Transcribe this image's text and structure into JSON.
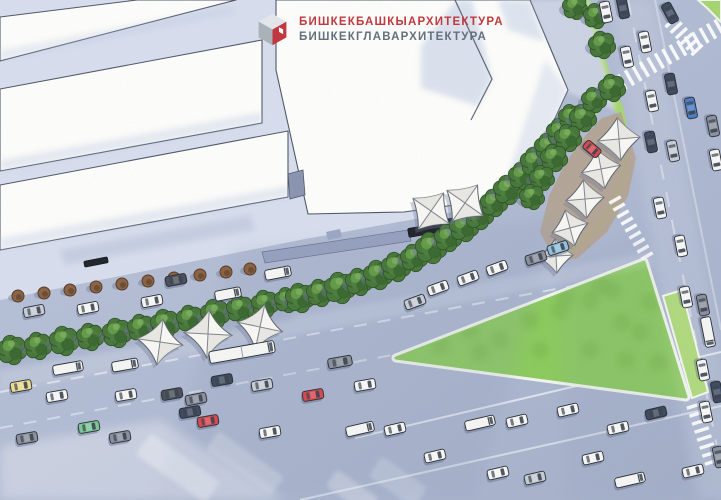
{
  "logo": {
    "line1": "БИШКЕКБАШКЫАРХИТЕКТУРА",
    "line2": "БИШКЕКГЛАВАРХИТЕКТУРА",
    "line1_color": "#c0393f",
    "line2_color": "#64707d",
    "cube_top": "#e3e6e9",
    "cube_left": "#a9b1b9",
    "cube_right": "#c0393f"
  },
  "palette": {
    "road_light": "#bcc5da",
    "road_dark": "#a4afc9",
    "building_area": "#d6ddec",
    "building_fill": "#fcfcfa",
    "building_stroke": "#4f5868",
    "roof_wash": "#b9c6e0",
    "grass": "#a6d471",
    "triangle_fill": "#8bc95e",
    "triangle_spot": "#78b54c",
    "triangle_border": "#f0f4ec",
    "plaza_fill": "#b2a391",
    "tree_dark": "#2d5226",
    "tree_mid": "#47763a",
    "tree_light": "#639a49",
    "tree_hi": "#79ad5c",
    "shrub_fill": "#8a6345",
    "shrub_core": "#6d4c33",
    "shrub_stroke": "#573a26",
    "shadow_blue": "#6d7894",
    "canopy_fill": "#f7f6f2",
    "canopy_shade": "#e4e3dd",
    "canopy_seam": "#80868f",
    "canopy_stroke": "#5d636e",
    "stripe_white": "#ffffff",
    "kiosk_fill": "#22262c",
    "car_outline": "#262b33",
    "car_colors": {
      "white": "#f4f5f3",
      "silver": "#c6cbd3",
      "gray": "#8a909c",
      "dark": "#4b505a",
      "navy": "#3e4a5e",
      "blue": "#4b7cc0",
      "lightblue": "#8fc0dc",
      "red": "#d4494f",
      "yellow": "#e9da8e",
      "green": "#7bc795"
    }
  },
  "scene": {
    "building_area": "0,0 530,0 568,90 519,200 300,240 0,300",
    "buildings": [
      {
        "name": "building-strip-a",
        "points": "0,17 137,0 236,0 0,61"
      },
      {
        "name": "building-strip-b",
        "points": "0,89 262,40 262,123 0,171"
      },
      {
        "name": "building-strip-c",
        "points": "0,185 288,131 288,197 0,250"
      },
      {
        "name": "building-central",
        "points": "276,0 530,0 568,90 519,196 404,212 308,214 276,70"
      }
    ],
    "connector": "288,174 303,170 305,195 290,199",
    "ramp": "262,252 408,230 411,241 265,263",
    "entrance": "326,232 340,229 342,237 328,240",
    "chevron_line": "455,0 492,79 471,120",
    "roof_washes": [
      {
        "points": "421,46 456,0 472,0 492,79 478,106 421,88",
        "o": 0.5
      },
      {
        "points": "498,0 530,0 545,42 508,30",
        "o": 0.45
      },
      {
        "points": "0,160 262,112 262,123 0,171",
        "o": 0.35
      },
      {
        "points": "0,238 288,186 288,197 0,250",
        "o": 0.35
      },
      {
        "points": "545,60 568,90 522,192 505,185",
        "o": 0.35
      },
      {
        "points": "0,50 230,6 236,13 0,61",
        "o": 0.3
      }
    ],
    "washes": [
      {
        "points": "60,250 250,215 255,230 65,265",
        "c": "#93a0bd",
        "o": 0.25,
        "b": 3
      },
      {
        "points": "0,350 290,305 292,322 0,368",
        "c": "#8a96b4",
        "o": 0.2,
        "b": 3
      },
      {
        "points": "235,248 560,218 475,500 155,500",
        "c": "#8795b5",
        "o": 0.13,
        "b": 6
      },
      {
        "points": "560,262 648,228 705,500 566,500",
        "c": "#8a96b4",
        "o": 0.1,
        "b": 6
      },
      {
        "points": "0,372 648,252 654,266 0,392",
        "c": "#ffffff",
        "o": 0.13,
        "b": 3
      },
      {
        "points": "0,446 160,420 285,500 0,500",
        "c": "#ffffff",
        "o": 0.3,
        "b": 5
      },
      {
        "points": "610,0 652,0 748,500 696,500",
        "c": "#ffffff",
        "o": 0.1,
        "b": 5
      },
      {
        "points": "528,0 588,0 616,110 566,92",
        "c": "#d9dfec",
        "o": 0.65,
        "b": 2
      }
    ],
    "lane_lines": [
      {
        "x1": 0,
        "y1": 392,
        "x2": 648,
        "y2": 272,
        "dash": "13 11",
        "o": 0.5
      },
      {
        "x1": 0,
        "y1": 428,
        "x2": 430,
        "y2": 348,
        "dash": "13 11",
        "o": 0.42
      },
      {
        "x1": 355,
        "y1": 438,
        "x2": 721,
        "y2": 352,
        "dash": "",
        "o": 0.6
      },
      {
        "x1": 300,
        "y1": 500,
        "x2": 721,
        "y2": 406,
        "dash": "",
        "o": 0.5
      },
      {
        "x1": 628,
        "y1": 0,
        "x2": 720,
        "y2": 462,
        "dash": "15 13",
        "o": 0.4
      },
      {
        "x1": 655,
        "y1": 0,
        "x2": 721,
        "y2": 330,
        "dash": "",
        "o": 0.32
      }
    ],
    "bands": [
      {
        "x": 178,
        "y": 468,
        "w": 26,
        "l": 85,
        "a": -55,
        "o": 0.32
      },
      {
        "x": 245,
        "y": 463,
        "w": 22,
        "l": 80,
        "a": -55,
        "o": 0.26
      },
      {
        "x": 352,
        "y": 492,
        "w": 20,
        "l": 50,
        "a": -55,
        "o": 0.3
      },
      {
        "x": 398,
        "y": 482,
        "w": 24,
        "l": 55,
        "a": -55,
        "o": 0.22
      }
    ],
    "green": {
      "triangle": "396,358 644,262 686,397",
      "triangle_spots": [
        [
          440,
          345
        ],
        [
          470,
          330
        ],
        [
          500,
          340
        ],
        [
          530,
          320
        ],
        [
          560,
          310
        ],
        [
          590,
          300
        ],
        [
          612,
          290
        ],
        [
          622,
          322
        ],
        [
          640,
          332
        ],
        [
          590,
          350
        ],
        [
          540,
          350
        ],
        [
          480,
          352
        ],
        [
          650,
          302
        ],
        [
          626,
          360
        ],
        [
          658,
          362
        ],
        [
          600,
          285
        ],
        [
          566,
          296
        ]
      ],
      "corner_ne": "698,0 721,0 721,22 707,8",
      "strip_se": "663,296 682,290 708,392 692,398",
      "paths": [
        {
          "d": "M 294,306 Q 470,250 600,104",
          "w": 9
        },
        {
          "d": "M 552,262 Q 648,210 618,104",
          "w": 8
        },
        {
          "d": "M 586,0 L 616,108",
          "w": 7
        }
      ]
    },
    "plaza": "540,232 549,196 566,162 585,136 602,118 621,112 636,158 628,196 607,232 578,258 556,262",
    "crosswalks": [
      {
        "x1": 622,
        "y1": 82,
        "x2": 719,
        "y2": 27,
        "len": 17,
        "n": 14
      },
      {
        "x1": 671,
        "y1": 22,
        "x2": 697,
        "y2": 50,
        "len": 15,
        "n": 6
      },
      {
        "x1": 615,
        "y1": 200,
        "x2": 647,
        "y2": 256,
        "len": 13,
        "n": 9
      },
      {
        "x1": 694,
        "y1": 406,
        "x2": 712,
        "y2": 462,
        "len": 15,
        "n": 8
      }
    ],
    "shrubs": [
      [
        18,
        296
      ],
      [
        44,
        293
      ],
      [
        70,
        290
      ],
      [
        96,
        287
      ],
      [
        122,
        284
      ],
      [
        148,
        281
      ],
      [
        174,
        278
      ],
      [
        200,
        275
      ],
      [
        226,
        272
      ],
      [
        250,
        269
      ]
    ],
    "trees": [
      [
        12,
        350,
        14
      ],
      [
        38,
        346,
        13
      ],
      [
        64,
        341,
        14
      ],
      [
        90,
        337,
        13
      ],
      [
        117,
        333,
        14
      ],
      [
        141,
        328,
        13
      ],
      [
        165,
        324,
        14
      ],
      [
        190,
        319,
        13
      ],
      [
        215,
        314,
        14
      ],
      [
        240,
        309,
        13
      ],
      [
        265,
        304,
        13
      ],
      [
        287,
        300,
        12
      ],
      [
        300,
        298,
        14
      ],
      [
        320,
        293,
        13
      ],
      [
        340,
        288,
        15
      ],
      [
        359,
        282,
        13
      ],
      [
        378,
        275,
        14
      ],
      [
        396,
        267,
        14
      ],
      [
        414,
        258,
        13
      ],
      [
        431,
        248,
        15
      ],
      [
        448,
        238,
        13
      ],
      [
        464,
        227,
        14
      ],
      [
        479,
        215,
        14
      ],
      [
        494,
        203,
        13
      ],
      [
        508,
        190,
        14
      ],
      [
        522,
        176,
        13
      ],
      [
        535,
        162,
        14
      ],
      [
        548,
        147,
        13
      ],
      [
        560,
        132,
        13
      ],
      [
        571,
        117,
        12
      ],
      [
        583,
        118,
        13
      ],
      [
        568,
        138,
        13
      ],
      [
        554,
        158,
        13
      ],
      [
        542,
        178,
        12
      ],
      [
        532,
        197,
        12
      ],
      [
        594,
        100,
        12
      ],
      [
        575,
        7,
        12
      ],
      [
        596,
        16,
        12
      ],
      [
        602,
        45,
        13
      ],
      [
        612,
        88,
        13
      ]
    ],
    "canopies": [
      {
        "x": 160,
        "y": 342,
        "s": 46,
        "a": 8,
        "k": "sail"
      },
      {
        "x": 208,
        "y": 334,
        "s": 48,
        "a": 3,
        "k": "sail"
      },
      {
        "x": 260,
        "y": 327,
        "s": 46,
        "a": 12,
        "k": "sail"
      },
      {
        "x": 431,
        "y": 211,
        "s": 31,
        "a": -10,
        "k": "sq"
      },
      {
        "x": 465,
        "y": 203,
        "s": 31,
        "a": -10,
        "k": "sq"
      },
      {
        "x": 619,
        "y": 139,
        "s": 30,
        "a": 40,
        "k": "sq"
      },
      {
        "x": 601,
        "y": 169,
        "s": 28,
        "a": 34,
        "k": "sq"
      },
      {
        "x": 585,
        "y": 199,
        "s": 27,
        "a": 40,
        "k": "sq"
      },
      {
        "x": 570,
        "y": 228,
        "s": 26,
        "a": 30,
        "k": "sq"
      },
      {
        "x": 556,
        "y": 256,
        "s": 24,
        "a": 42,
        "k": "sq"
      }
    ],
    "kiosks": [
      {
        "x": 431,
        "y": 229,
        "l": 46,
        "w": 9,
        "a": -10
      },
      {
        "x": 466,
        "y": 220,
        "l": 40,
        "w": 9,
        "a": -11
      },
      {
        "x": 96,
        "y": 262,
        "l": 24,
        "w": 6,
        "a": -11
      }
    ],
    "cars": [
      [
        34,
        311,
        -11,
        "silver"
      ],
      [
        88,
        308,
        -11,
        "white"
      ],
      [
        152,
        301,
        -11,
        "white"
      ],
      [
        176,
        280,
        -11,
        "dark"
      ],
      [
        228,
        294,
        -11,
        "white",
        26
      ],
      [
        278,
        273,
        -11,
        "white",
        26
      ],
      [
        68,
        368,
        -10,
        "white",
        30
      ],
      [
        125,
        365,
        -10,
        "white",
        26
      ],
      [
        242,
        352,
        -10,
        "white",
        66
      ],
      [
        340,
        362,
        -10,
        "gray",
        24
      ],
      [
        21,
        386,
        -10,
        "yellow"
      ],
      [
        57,
        396,
        -10,
        "white"
      ],
      [
        126,
        395,
        -10,
        "white"
      ],
      [
        172,
        394,
        -10,
        "dark"
      ],
      [
        196,
        399,
        -11,
        "gray"
      ],
      [
        222,
        380,
        -10,
        "navy"
      ],
      [
        262,
        385,
        -10,
        "silver"
      ],
      [
        313,
        395,
        -10,
        "red"
      ],
      [
        365,
        385,
        -10,
        "white"
      ],
      [
        190,
        412,
        -10,
        "navy"
      ],
      [
        208,
        421,
        -10,
        "red"
      ],
      [
        89,
        427,
        -10,
        "green"
      ],
      [
        27,
        438,
        -10,
        "gray"
      ],
      [
        120,
        437,
        -10,
        "gray"
      ],
      [
        270,
        432,
        -10,
        "white"
      ],
      [
        415,
        302,
        -20,
        "silver"
      ],
      [
        438,
        288,
        -20,
        "white"
      ],
      [
        468,
        278,
        -20,
        "white"
      ],
      [
        497,
        268,
        -20,
        "white"
      ],
      [
        536,
        258,
        -18,
        "gray"
      ],
      [
        558,
        248,
        -18,
        "lightblue"
      ],
      [
        360,
        429,
        -13,
        "white",
        28
      ],
      [
        395,
        429,
        -13,
        "white"
      ],
      [
        480,
        423,
        -13,
        "white",
        30
      ],
      [
        517,
        421,
        -13,
        "white"
      ],
      [
        435,
        456,
        -13,
        "white"
      ],
      [
        498,
        473,
        -13,
        "white"
      ],
      [
        535,
        478,
        -13,
        "silver"
      ],
      [
        568,
        410,
        -13,
        "white"
      ],
      [
        618,
        428,
        -13,
        "white"
      ],
      [
        656,
        413,
        -13,
        "navy"
      ],
      [
        593,
        458,
        -13,
        "white"
      ],
      [
        630,
        480,
        -13,
        "white",
        30
      ],
      [
        693,
        471,
        -13,
        "white"
      ],
      [
        606,
        12,
        79,
        "white"
      ],
      [
        623,
        8,
        79,
        "navy"
      ],
      [
        670,
        13,
        62,
        "navy"
      ],
      [
        645,
        42,
        79,
        "white"
      ],
      [
        627,
        57,
        79,
        "white"
      ],
      [
        671,
        84,
        79,
        "navy"
      ],
      [
        652,
        101,
        79,
        "white"
      ],
      [
        691,
        108,
        79,
        "blue"
      ],
      [
        713,
        126,
        79,
        "gray"
      ],
      [
        651,
        142,
        79,
        "navy"
      ],
      [
        673,
        151,
        79,
        "silver"
      ],
      [
        716,
        160,
        79,
        "white"
      ],
      [
        660,
        208,
        79,
        "white"
      ],
      [
        681,
        246,
        79,
        "white"
      ],
      [
        686,
        297,
        79,
        "white"
      ],
      [
        703,
        305,
        79,
        "gray"
      ],
      [
        708,
        332,
        79,
        "white",
        30
      ],
      [
        703,
        370,
        79,
        "white"
      ],
      [
        717,
        392,
        79,
        "navy"
      ],
      [
        706,
        412,
        79,
        "white"
      ],
      [
        719,
        457,
        79,
        "gray"
      ],
      [
        592,
        149,
        40,
        "red",
        18
      ]
    ]
  }
}
